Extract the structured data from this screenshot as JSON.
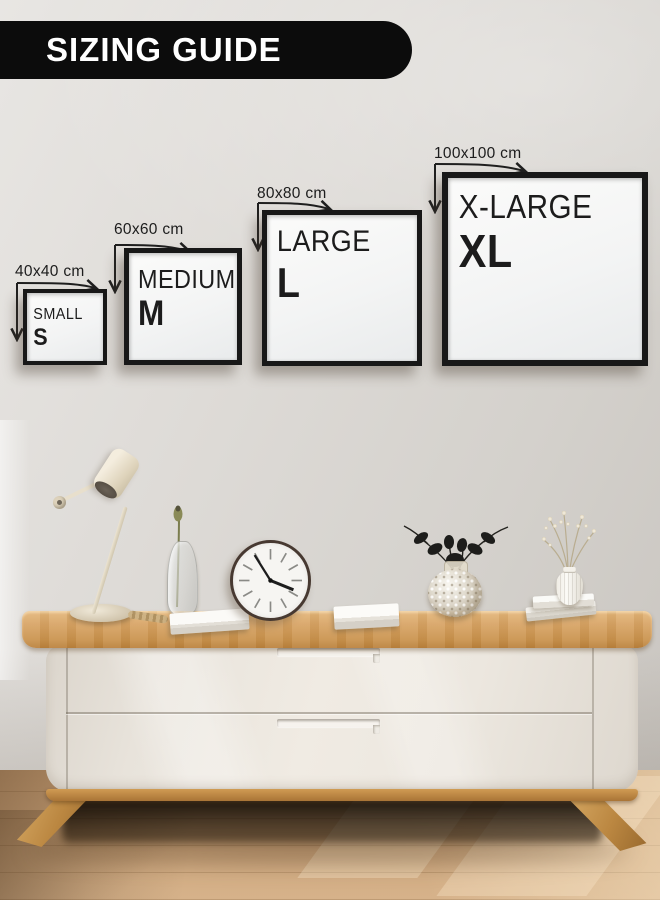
{
  "banner": {
    "title": "SIZING GUIDE"
  },
  "frames": [
    {
      "id": "small",
      "dimension_label": "40x40 cm",
      "name": "SMALL",
      "code": "S"
    },
    {
      "id": "medium",
      "dimension_label": "60x60 cm",
      "name": "MEDIUM",
      "code": "M"
    },
    {
      "id": "large",
      "dimension_label": "80x80 cm",
      "name": "LARGE",
      "code": "L"
    },
    {
      "id": "xlarge",
      "dimension_label": "100x100 cm",
      "name": "X-LARGE",
      "code": "XL"
    }
  ],
  "colors": {
    "banner_bg": "#0c0c0c",
    "banner_text": "#ffffff",
    "frame_border": "#181818",
    "frame_text": "#1c1c1c",
    "dimension_text": "#1d1d1d",
    "wall": "#d8d5d1",
    "wood": "#d3a05c",
    "cabinet_body": "#eae5dd",
    "floor": "#c9a378"
  },
  "scene": {
    "decor_items": [
      "desk-lamp",
      "bud-vase",
      "book",
      "wall-clock",
      "book",
      "bubble-vase-with-black-flowers",
      "stacked-books",
      "ribbed-vase-with-dried-flowers"
    ]
  }
}
